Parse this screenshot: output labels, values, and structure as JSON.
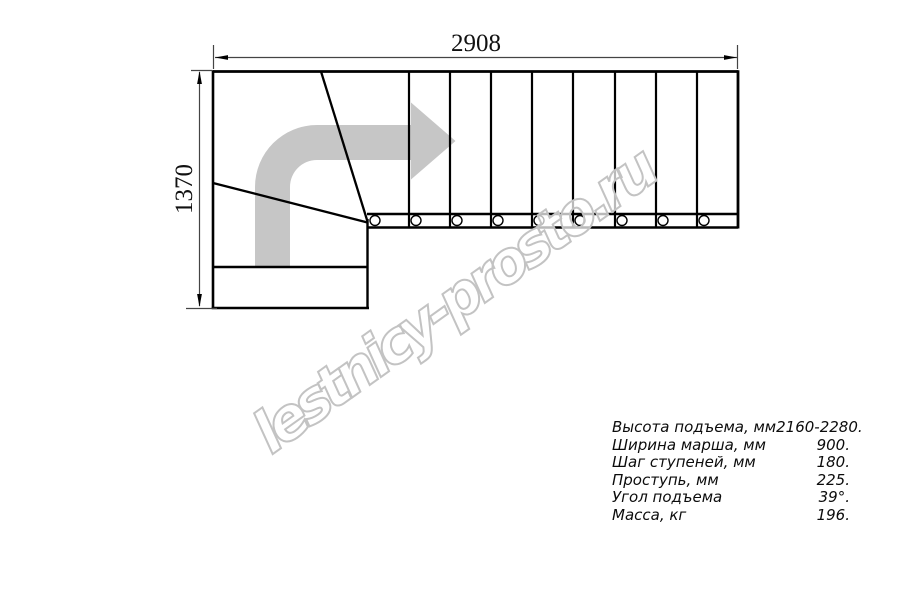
{
  "drawing": {
    "dim_width_label": "2908",
    "dim_height_label": "1370",
    "watermark_text": "lestnicy-prosto.ru",
    "colors": {
      "line": "#000000",
      "dimension_line": "#444444",
      "arrow_gray": "#c6c6c6",
      "watermark_outline": "#c3c3c3"
    }
  },
  "specs": {
    "rows": [
      {
        "label": "Высота подъема, мм",
        "value": "2160-2280."
      },
      {
        "label": "Ширина марша, мм",
        "value": "900."
      },
      {
        "label": "Шаг ступеней, мм",
        "value": "180."
      },
      {
        "label": "Проступь, мм",
        "value": "225."
      },
      {
        "label": "Угол подъема",
        "value": "39°."
      },
      {
        "label": "Масса, кг",
        "value": "196."
      }
    ]
  }
}
